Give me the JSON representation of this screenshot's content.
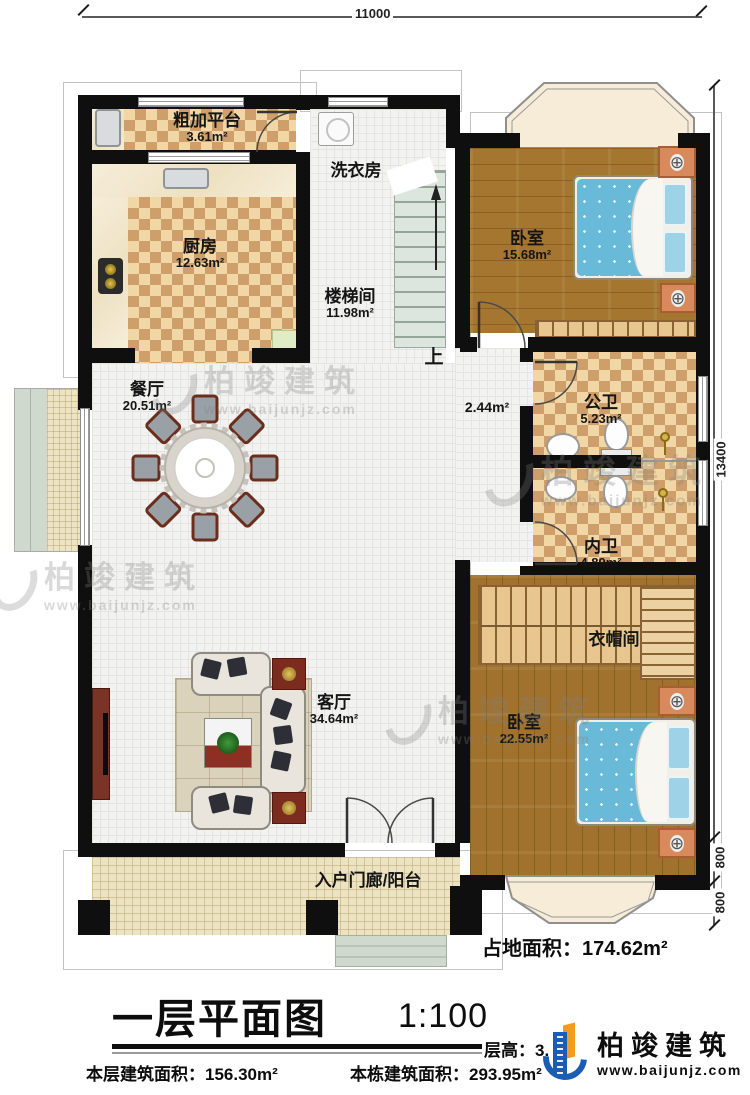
{
  "dimensions": {
    "top": "11000",
    "right_main": "13400",
    "right_seg_a": "800",
    "right_seg_b": "800"
  },
  "rooms": {
    "rough_platform": {
      "name": "粗加平台",
      "area": "3.61m²"
    },
    "kitchen": {
      "name": "厨房",
      "area": "12.63m²"
    },
    "laundry": {
      "name": "洗衣房"
    },
    "stairwell": {
      "name": "楼梯间",
      "area": "11.98m²"
    },
    "bedroom1": {
      "name": "卧室",
      "area": "15.68m²"
    },
    "dining": {
      "name": "餐厅",
      "area": "20.51m²"
    },
    "hallway": {
      "area": "2.44m²"
    },
    "public_bath": {
      "name": "公卫",
      "area": "5.23m²"
    },
    "inner_bath": {
      "name": "内卫",
      "area": "4.89m²"
    },
    "cloakroom": {
      "name": "衣帽间"
    },
    "bedroom2": {
      "name": "卧室",
      "area": "22.55m²"
    },
    "living": {
      "name": "客厅",
      "area": "34.64m²"
    },
    "porch": {
      "name": "入户门廊/阳台"
    }
  },
  "stairs": {
    "up": "上"
  },
  "site": {
    "footprint": "占地面积：174.62m²"
  },
  "titleblock": {
    "title": "一层平面图",
    "scale": "1:100",
    "floor_height": "层高：3.",
    "floor_area": "本层建筑面积：156.30m²",
    "building_area": "本栋建筑面积：293.95m²"
  },
  "brand": {
    "name": "柏竣建筑",
    "site": "www.baijunjz.com"
  },
  "watermark": {
    "name": "柏竣建筑",
    "site": "www.baijunjz.com"
  },
  "colors": {
    "accent_blue": "#1b5cb5",
    "accent_orange": "#f5991f",
    "wall": "#0f0f0f",
    "wood": "#a5762f",
    "bed": "#69b9d8"
  }
}
